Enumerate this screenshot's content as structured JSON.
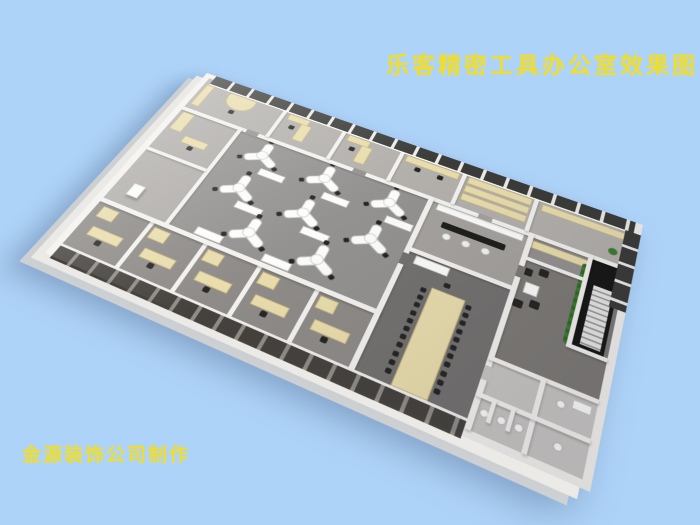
{
  "title": {
    "text": "乐客精密工具办公室效果图"
  },
  "credit": {
    "text": "金源装饰公司制作"
  },
  "palette": {
    "background": "#aed3f8",
    "title_yellow": "#f0dd2c",
    "wall_white": "#f3f2ef",
    "floor_gray": "#949290",
    "floor_light": "#b3b0ac",
    "floor_dark": "#747170",
    "furniture_cream": "#e9ddad",
    "window_dark": "#3b3b39",
    "chair_black": "#262624",
    "desk_white": "#fcfcfb",
    "plant_green": "#3f7a30",
    "stair_black": "#171715",
    "toilet_floor": "#c8c6c3"
  },
  "scene": {
    "description": "3D isometric rendering of an office floor plan for Leke Precision Tools",
    "open_office": {
      "y_desk_count": 8,
      "desk_positions": [
        [
          112,
          82
        ],
        [
          192,
          82
        ],
        [
          272,
          82
        ],
        [
          112,
          140
        ],
        [
          192,
          140
        ],
        [
          272,
          140
        ],
        [
          152,
          192
        ],
        [
          232,
          192
        ]
      ]
    },
    "conference": {
      "chairs_per_side": 11,
      "end_chairs": 2
    },
    "private_offices": {
      "count": 5
    },
    "bar_stools": 3,
    "lounge": {
      "armchair_positions": [
        [
          452,
          120
        ],
        [
          468,
          114
        ],
        [
          452,
          164
        ],
        [
          468,
          158
        ]
      ]
    }
  }
}
